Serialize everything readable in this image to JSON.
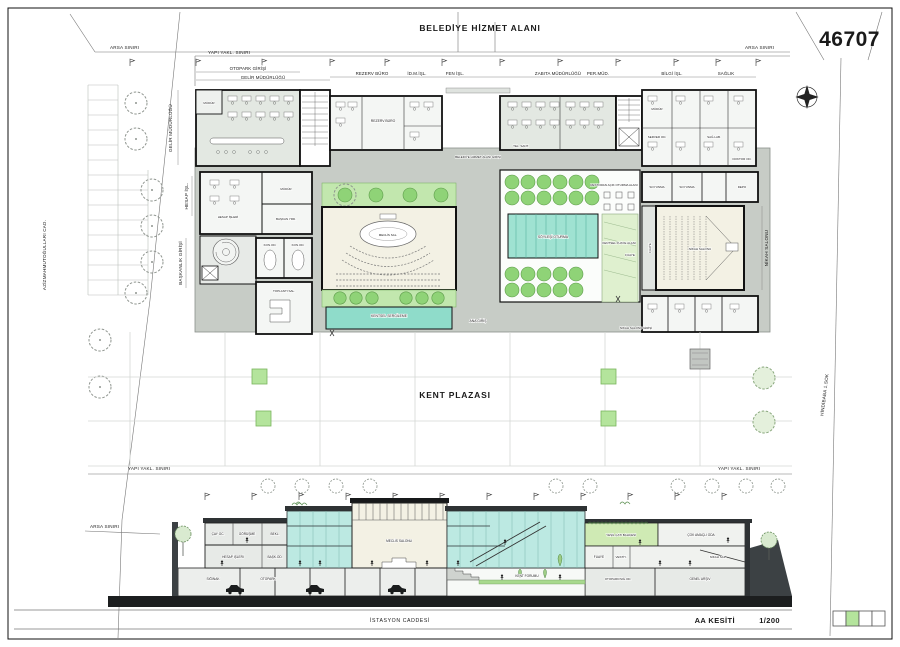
{
  "sheet": {
    "number": "46707",
    "belediye_hizmet_alani": "BELEDİYE HİZMET ALANI",
    "kent_plazasi": "KENT PLAZASI",
    "istasyon_caddesi": "İSTASYON CADDESİ",
    "azizmahmut_cad": "AZİZMAHMUTOĞULLARI CAD.",
    "hindibaba_sok": "HİNDİBABA 1.SOK",
    "section_title": "AA KESİTİ",
    "section_scale": "1/200"
  },
  "boundaries": {
    "arsa": "ARSA SINIRI",
    "yapi": "YAPI YAKL. SINIRI"
  },
  "plan": {
    "dims": {
      "otopark_girisi": "OTOPARK GİRİŞİ",
      "gelir": "GELİR MÜDÜRLÜĞÜ",
      "rezerv": "REZERV BÜRO",
      "idm": "İD.M.İŞL.",
      "fen": "FEN İŞL.",
      "zabita": "ZABITA MÜDÜRLÜĞÜ",
      "per_mud": "PER.MÜD.",
      "bilgi": "BİLGİ İŞL.",
      "saglik": "SAĞLIK"
    },
    "side": {
      "gelir_v": "GELİR MÜDÜRLÜĞÜ",
      "hesap_v": "HESAP İŞL.",
      "baskanlik_v": "BAŞKANLIK GİRİŞİ",
      "nikah_v": "NİKAH SALONU",
      "fuaye_v": "FUAYE"
    },
    "rooms": {
      "mudur": "MÜDÜR",
      "hesap_isleri": "HESAP İŞLERİ",
      "baskan_yrd": "BAŞKAN YRD.",
      "kon_od": "KON.OD.",
      "toplanti": "TOPLANTI SAL.",
      "meclis": "MECLİS SAL.",
      "kentsel_sergileme": "KENTSEL SERGİLEME",
      "restoran": "RESTORAN AÇIK OTURMA ALANI",
      "soylesi": "SÖYLEŞİ OTURMA",
      "kentsel_fuaye": "KENTSEL FUAYE ALANI",
      "fuaye": "FUAYE",
      "soyunma": "SOYUNMA",
      "depo": "DEPO",
      "nikah_salonu": "NİKAH SALONU",
      "server_od": "SERVER OD.",
      "doktor_od": "DOKTOR OD.",
      "sag_lab": "SAĞ.LAB.",
      "tel_sant": "TEL. SANT.",
      "hizmet_girisi": "BELEDİYE HİZMET ALANI GİRİŞİ",
      "ana_giris": "ANA GİRİŞ",
      "nikah_girisi": "NİKAH SALONU GİRİŞİ",
      "rezerv_in": "REZERV BÜRO"
    }
  },
  "section": {
    "rooms": {
      "cay_oc": "ÇAY OC.",
      "gorusme": "GÖRÜŞME",
      "bekl": "BEKL.",
      "hesap_isleri": "HESAP İŞLERİ",
      "bask_od": "BAŞK.OD.",
      "siginak": "SIĞINAK",
      "otopark": "OTOPARK",
      "meclis_salonu": "MECLİS SALONU",
      "kent_forumu": "KENT FORUMU",
      "otopark_sig": "OTOPARK/SIĞ.OD.",
      "genel_arsiv": "GENEL ARŞİV",
      "fuaye": "FUAYE",
      "vestiyer": "VESTİY.",
      "yesil_cati": "YEŞİL ÇATI BAHÇESİ",
      "cok_amacli": "ÇOK AMAÇLI ODA",
      "nikah_sal": "NİKAH SAL."
    }
  },
  "colors": {
    "deck": "#c7ccc6",
    "office_tint": "#e3e8e2",
    "tree_green": "#8fd377",
    "band_green": "#c2e7ae",
    "teal": "#8fdcca",
    "glass": "#bce9e2",
    "hall_cream": "#f3f1e4",
    "legend_green": "#b4e49c",
    "ground_dark": "#3c4144",
    "street_black": "#1c1e1f"
  }
}
